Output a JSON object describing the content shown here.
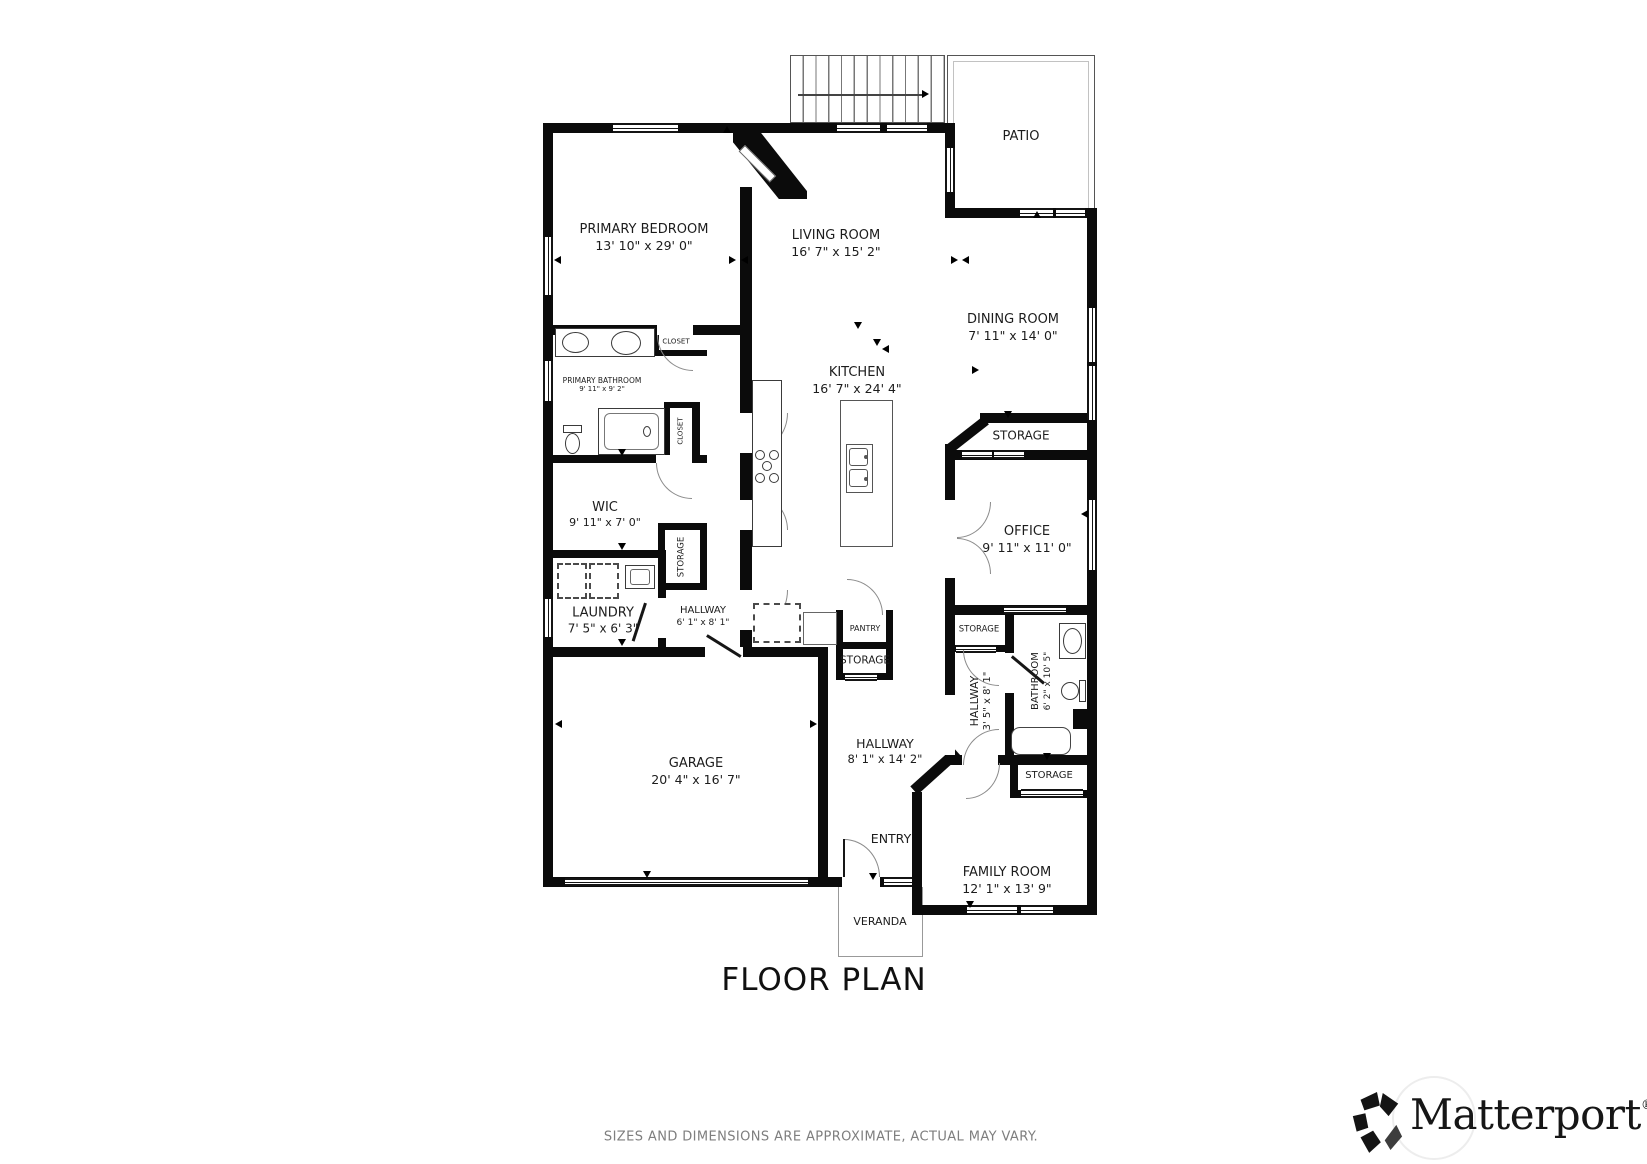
{
  "title": "FLOOR PLAN",
  "disclaimer": "SIZES AND DIMENSIONS ARE APPROXIMATE, ACTUAL MAY VARY.",
  "brand": {
    "name": "Matterport",
    "registered": "®"
  },
  "rooms": {
    "primary_bedroom": {
      "name": "PRIMARY BEDROOM",
      "dims": "13' 10\" x 29' 0\""
    },
    "living_room": {
      "name": "LIVING ROOM",
      "dims": "16' 7\" x 15' 2\""
    },
    "patio": {
      "name": "PATIO"
    },
    "dining_room": {
      "name": "DINING ROOM",
      "dims": "7' 11\" x 14' 0\""
    },
    "kitchen": {
      "name": "KITCHEN",
      "dims": "16' 7\" x 24' 4\""
    },
    "primary_bathroom": {
      "name": "PRIMARY BATHROOM",
      "dims": "9' 11\" x 9' 2\""
    },
    "closet_top": {
      "name": "CLOSET"
    },
    "closet_side": {
      "name": "CLOSET"
    },
    "wic": {
      "name": "WIC",
      "dims": "9' 11\" x 7' 0\""
    },
    "storage_wic": {
      "name": "STORAGE"
    },
    "laundry": {
      "name": "LAUNDRY",
      "dims": "7' 5\" x 6' 3\""
    },
    "hallway_small": {
      "name": "HALLWAY",
      "dims": "6' 1\" x 8' 1\""
    },
    "garage": {
      "name": "GARAGE",
      "dims": "20' 4\" x 16' 7\""
    },
    "pantry": {
      "name": "PANTRY"
    },
    "storage_pantry": {
      "name": "STORAGE"
    },
    "storage_dining": {
      "name": "STORAGE"
    },
    "office": {
      "name": "OFFICE",
      "dims": "9' 11\" x 11' 0\""
    },
    "storage_hall": {
      "name": "STORAGE"
    },
    "hallway_bath": {
      "name": "HALLWAY",
      "dims": "3' 5\" x 8' 1\""
    },
    "bathroom": {
      "name": "BATHROOM",
      "dims": "6' 2\" x 10' 5\""
    },
    "storage_family": {
      "name": "STORAGE"
    },
    "hallway_main": {
      "name": "HALLWAY",
      "dims": "8' 1\" x 14' 2\""
    },
    "entry": {
      "name": "ENTRY"
    },
    "family_room": {
      "name": "FAMILY ROOM",
      "dims": "12' 1\" x 13' 9\""
    },
    "veranda": {
      "name": "VERANDA"
    }
  }
}
